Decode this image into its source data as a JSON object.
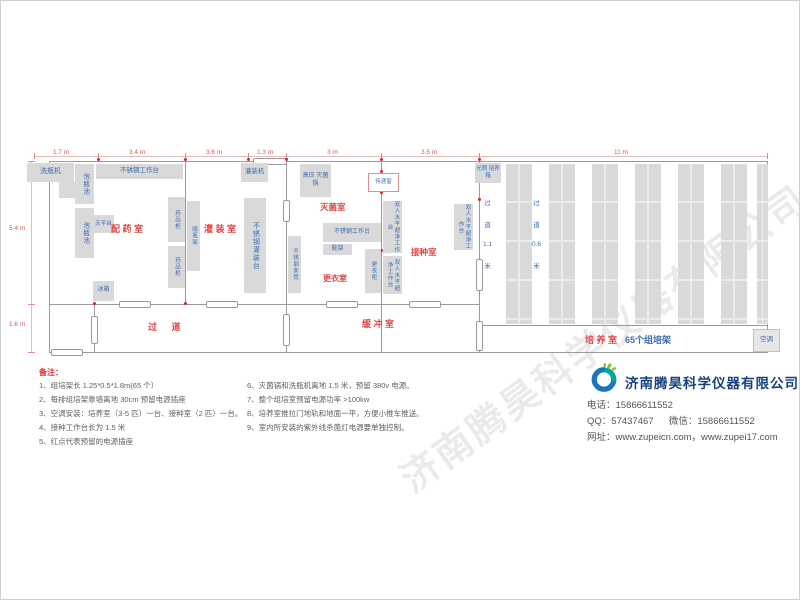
{
  "plan": {
    "top_dims": [
      {
        "label": "1.7 m"
      },
      {
        "label": "3.4 m"
      },
      {
        "label": "3.6 m"
      },
      {
        "label": "1.3 m"
      },
      {
        "label": "3 m"
      },
      {
        "label": "3.5 m"
      },
      {
        "label": "11 m"
      }
    ],
    "left_dims": [
      {
        "label": "5.4 m"
      },
      {
        "label": "1.6 m"
      }
    ],
    "rooms": {
      "peiyao": "配 药 室",
      "guanzhuang": "灌 装 室",
      "miejun": "灭菌室",
      "jiezhong": "接种室",
      "gengyi": "更衣室",
      "huanchong": "缓 冲 室",
      "guodao": "过    道",
      "peiyang_red": "培 养 室",
      "peiyang_blue": "65个组培架"
    },
    "aisles": [
      {
        "chars": [
          "过",
          "道",
          "1.1",
          "米"
        ]
      },
      {
        "chars": [
          "过",
          "道",
          "0.6",
          "米"
        ]
      }
    ],
    "equipment": {
      "xipingji": "洗瓶机",
      "paopingchi": "泡瓶池",
      "bxg_gongzuotai": "不锈钢工作台",
      "tianpingtai": "天平台",
      "yaopingui": "药品柜",
      "bingxiang": "冰箱",
      "shunpingjia": "顺瓶架",
      "guanzhuangji": "灌装机",
      "bxg_guanzhuangtai": "不锈钢灌装台",
      "gaoya_miejunguo": "高压 灭菌锅",
      "chuandichuang": "传递窗",
      "xiejia": "鞋架",
      "bxg_tiaodeng": "不锈钢条凳",
      "gengyigui": "更衣柜",
      "chaojing_tai": "双人水平超净工作台",
      "guangzhao_pyx": "光照 培养箱",
      "kongtiao": "空调"
    }
  },
  "notes": {
    "title": "备注：",
    "left": [
      "1、组培架长 1.25*0.5*1.8m(65 个）",
      "2、每排组培架靠墙离地 30cm 预留电源插座",
      "3、空调安装：培养室（3-5 匹）一台、接种室（2 匹）一台。",
      "4、接种工作台长为 1.5 米",
      "5、红点代表预留的电源插座"
    ],
    "right": [
      "6、灭菌锅和洗瓶机离地 1.5 米，预留 380v 电源。",
      "7、整个组培室预留电源功率 >100kw",
      "8、培养室推拉门地轨和地面一平，方便小推车推送。",
      "9、室内所安装的紫外线杀菌灯电源要单独控制。"
    ]
  },
  "company": {
    "name": "济南腾昊科学仪器有限公司",
    "phone_label": "电话：",
    "phone": "15866611552",
    "qq_label": "QQ：",
    "qq": "57437467",
    "wechat_label": "微信：",
    "wechat": "15866611552",
    "web_label": "网址：",
    "web": "www.zupeicn.com，www.zupei17.com"
  },
  "watermark": "济南腾昊科学仪器有限公司",
  "colors": {
    "room_label": "#e04545",
    "equipment_label": "#3a6cb4",
    "dimension": "#e05050",
    "company_name": "#17407e",
    "outlet_dot": "#e02020",
    "rack_fill": "#d9d9d9"
  }
}
